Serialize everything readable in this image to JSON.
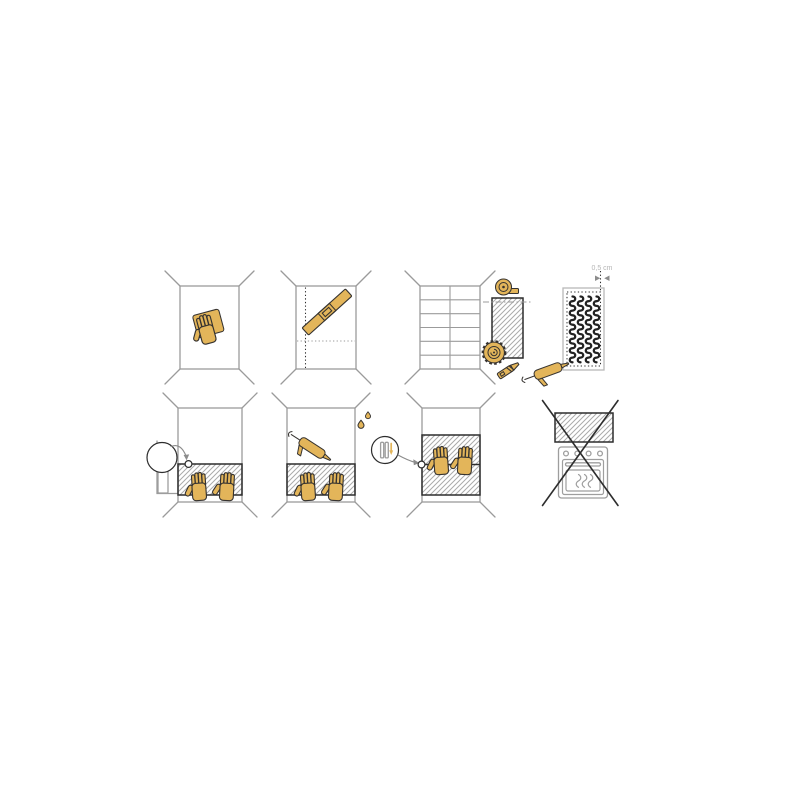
{
  "canvas": {
    "width": 800,
    "height": 800,
    "background": "#ffffff"
  },
  "figure": {
    "type": "installation-instruction-diagram",
    "rows": 2,
    "columns": 4
  },
  "colors": {
    "accent": "#e3b55a",
    "outline": "#363330",
    "wall": "#9b9b9b",
    "hatch": "#aaaaaa",
    "panel": "#2d2d2d",
    "annotation": "#8c8c8c",
    "label": "#b5b5b5",
    "squiggle": "#222222",
    "fixture": "#9e9e9e",
    "lightline": "#b8b8b8"
  },
  "annotations": {
    "measurement_label": "0,5 cm"
  },
  "panels": [
    {
      "step": 1,
      "name": "clean-wall",
      "icons": [
        "wall-perspective",
        "sanding-sponge-hand-icon"
      ]
    },
    {
      "step": 2,
      "name": "mark-guide-lines",
      "icons": [
        "wall-perspective",
        "vertical-dotted-guide-line",
        "horizontal-dotted-guide-line",
        "spirit-level-icon"
      ]
    },
    {
      "step": 3,
      "name": "measure-and-cut-panel",
      "icons": [
        "tiled-wall",
        "tape-measure-icon",
        "hatched-panel",
        "cut-dashdot-line",
        "circular-saw-icon",
        "utility-knife-icon"
      ]
    },
    {
      "step": 4,
      "name": "apply-adhesive-to-panel-back",
      "icons": [
        "panel-back",
        "dotted-margin",
        "adhesive-bead-squiggles",
        "caulking-gun-icon"
      ],
      "measurement": "0,5 cm"
    },
    {
      "step": 5,
      "name": "position-panel-with-spacer",
      "icons": [
        "wall-perspective",
        "hatched-panel",
        "pressing-hands-icon",
        "adhesive-tube-icon",
        "nozzle-detail-circle",
        "corner-marker-circle"
      ]
    },
    {
      "step": 6,
      "name": "seal-top-edge",
      "icons": [
        "wall-perspective",
        "hatched-panel",
        "pressing-hands-icon",
        "caulking-gun-icon",
        "water-drops-icon"
      ]
    },
    {
      "step": 7,
      "name": "join-second-panel",
      "icons": [
        "wall-perspective",
        "two-hatched-panels-with-seam",
        "pressing-hands-icon",
        "seam-detail-circle",
        "down-arrow-detail",
        "seam-marker-circle"
      ]
    },
    {
      "step": 8,
      "name": "do-not-mount-above-oven",
      "prohibited": true,
      "icons": [
        "hatched-panel",
        "oven-icon",
        "prohibition-cross-icon"
      ]
    }
  ]
}
